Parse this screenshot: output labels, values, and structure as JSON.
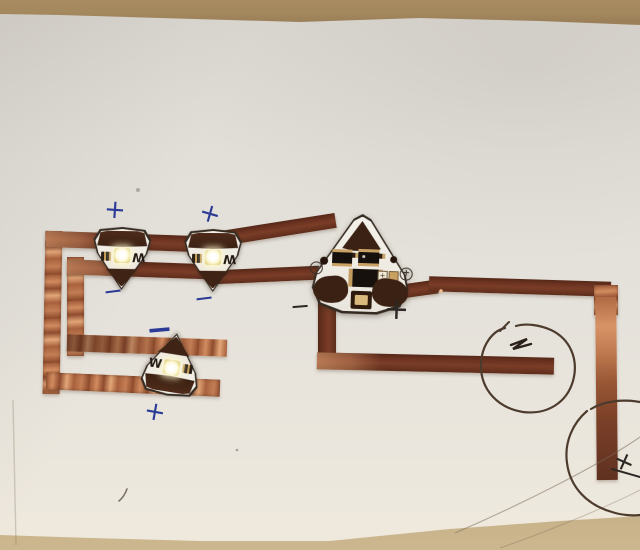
{
  "scene": {
    "description": "Photograph of a hand-made paper circuit: copper tape traces on white paper with three white LED circuit stickers, one effects sticker, hand-drawn polarity marks and two pen-drawn battery circles."
  },
  "stickers": {
    "led1": {
      "label": "W"
    },
    "led2": {
      "label": "W"
    },
    "led3": {
      "label": "W"
    },
    "effect": {
      "minus_label": "−",
      "plus_label": "+",
      "plus_cell_label": "+"
    }
  },
  "annotations": {
    "marks": [
      {
        "symbol": "+",
        "ink": "blue",
        "location": "above-led1"
      },
      {
        "symbol": "+",
        "ink": "blue",
        "location": "above-led2"
      },
      {
        "symbol": "−",
        "ink": "blue",
        "location": "below-led1"
      },
      {
        "symbol": "−",
        "ink": "blue",
        "location": "below-led2"
      },
      {
        "symbol": "−",
        "ink": "blue",
        "location": "above-led3"
      },
      {
        "symbol": "+",
        "ink": "blue",
        "location": "below-led3"
      },
      {
        "symbol": "−",
        "ink": "black",
        "location": "left-of-effect-sticker"
      },
      {
        "symbol": "+",
        "ink": "black",
        "location": "right-of-effect-sticker"
      },
      {
        "symbol": "+",
        "ink": "black",
        "location": "right-edge-scribble"
      }
    ]
  },
  "colors": {
    "copper_matte": "#6e3421",
    "copper_shiny": "#d28c60",
    "paper": "#e3e0da",
    "table": "#b79c71",
    "ink_blue": "#2b3a96",
    "ink_black": "#2e2824",
    "pen_circle": "#4d3b2d",
    "led_glow": "#fdf8d8",
    "sticker_pad": "#3b2113"
  }
}
